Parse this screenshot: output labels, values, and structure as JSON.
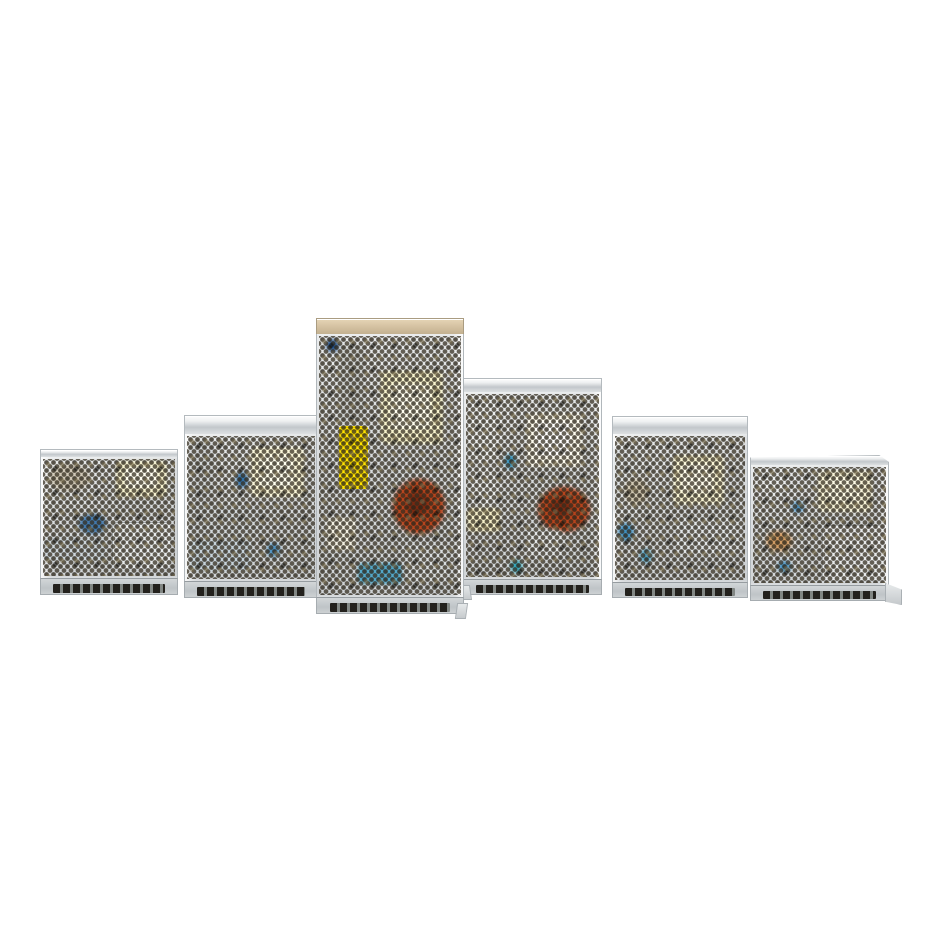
{
  "scene": {
    "type": "product-photograph",
    "description": "Six silver enclosed switching power supply units with perforated metal mesh cases, arranged in a row (heights rising to a tall center unit then descending) on a plain white background",
    "background_color": "#ffffff",
    "item_count": 6
  },
  "colors": {
    "case_metal": "#d7dadc",
    "case_highlight": "#eef0f1",
    "mesh_hole_dark": "#342e21",
    "top_cap_silver": "#dde0e2",
    "top_cap_tan": "#d3c0a0",
    "label_yellow": "#ffe400",
    "transformer_cream": "#f7f3d0",
    "transformer_white": "#fffef0",
    "toroid_red": "#b7431c",
    "capacitor_blue": "#4178ad",
    "panel_grey": "#e6e9ea",
    "terminal_dark": "#23211d"
  },
  "products": [
    {
      "id": "psu-1",
      "position": "far-left",
      "relative_height": "short",
      "visible_components": [
        "cream transformer upper right",
        "blue capacitor left",
        "inner bracket panel lower right",
        "screw terminal row"
      ]
    },
    {
      "id": "psu-2",
      "position": "second-left",
      "relative_height": "medium",
      "visible_components": [
        "bright cream transformer top center",
        "blue capacitor",
        "grey bands lower left",
        "screw terminal row"
      ]
    },
    {
      "id": "psu-3",
      "position": "center-left",
      "relative_height": "tallest",
      "visible_components": [
        "yellow spec label behind mesh",
        "cream transformer upper right",
        "red toroid inductor mid right",
        "blue capacitors bottom",
        "tan top cover",
        "screw terminal row"
      ]
    },
    {
      "id": "psu-4",
      "position": "center-right",
      "relative_height": "tall",
      "visible_components": [
        "white transformer upper right",
        "red toroid inductor mid right",
        "large pale capacitors upper left",
        "cream component lower left",
        "screw terminal row"
      ]
    },
    {
      "id": "psu-5",
      "position": "second-right",
      "relative_height": "medium",
      "visible_components": [
        "cream transformer top center",
        "grey panel lower right",
        "blue capacitors left",
        "screw terminal row"
      ]
    },
    {
      "id": "psu-6",
      "position": "far-right",
      "relative_height": "short",
      "visible_components": [
        "cream transformer upper right",
        "grey panel lower right",
        "tan capacitor left",
        "blue capacitors",
        "right mounting flange",
        "screw terminal row"
      ]
    }
  ]
}
